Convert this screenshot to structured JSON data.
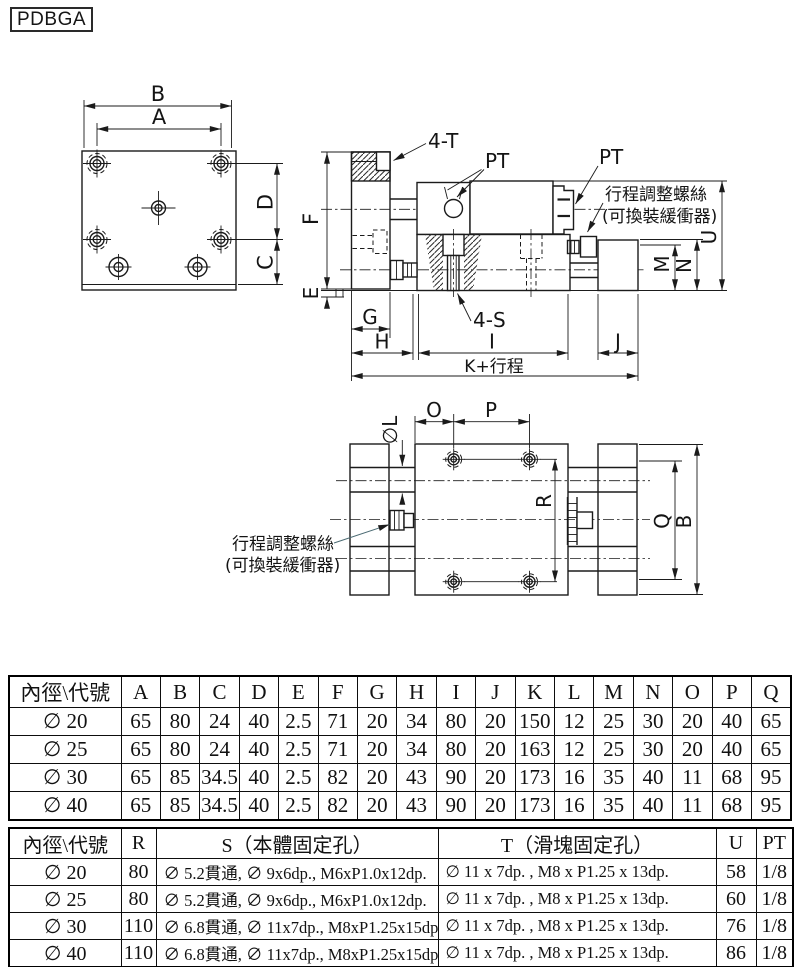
{
  "model_label": "PDBGA",
  "front_view": {
    "dim_B": "B",
    "dim_A": "A",
    "dim_D": "D",
    "dim_C": "C"
  },
  "side_view": {
    "label_4T": "4-T",
    "label_PT_left": "PT",
    "label_PT_right": "PT",
    "note_line1": "行程調整螺絲",
    "note_line2": "(可換裝緩衝器)",
    "label_4S": "4-S",
    "dim_F": "F",
    "dim_E": "E",
    "dim_G": "G",
    "dim_H": "H",
    "dim_I": "I",
    "dim_J": "J",
    "dim_K_stroke": "K+行程",
    "dim_M": "M",
    "dim_N": "N",
    "dim_U": "U"
  },
  "top_view": {
    "dim_O": "O",
    "dim_P": "P",
    "dim_L": "∅L",
    "dim_R": "R",
    "dim_Q": "Q",
    "dim_B": "B",
    "note_line1": "行程調整螺絲",
    "note_line2": "(可換裝緩衝器)"
  },
  "dimension_table": {
    "header": [
      "內徑\\代號",
      "A",
      "B",
      "C",
      "D",
      "E",
      "F",
      "G",
      "H",
      "I",
      "J",
      "K",
      "L",
      "M",
      "N",
      "O",
      "P",
      "Q"
    ],
    "rows": [
      [
        "∅ 20",
        "65",
        "80",
        "24",
        "40",
        "2.5",
        "71",
        "20",
        "34",
        "80",
        "20",
        "150",
        "12",
        "25",
        "30",
        "20",
        "40",
        "65"
      ],
      [
        "∅ 25",
        "65",
        "80",
        "24",
        "40",
        "2.5",
        "71",
        "20",
        "34",
        "80",
        "20",
        "163",
        "12",
        "25",
        "30",
        "20",
        "40",
        "65"
      ],
      [
        "∅ 30",
        "65",
        "85",
        "34.5",
        "40",
        "2.5",
        "82",
        "20",
        "43",
        "90",
        "20",
        "173",
        "16",
        "35",
        "40",
        "11",
        "68",
        "95"
      ],
      [
        "∅ 40",
        "65",
        "85",
        "34.5",
        "40",
        "2.5",
        "82",
        "20",
        "43",
        "90",
        "20",
        "173",
        "16",
        "35",
        "40",
        "11",
        "68",
        "95"
      ]
    ]
  },
  "mounting_table": {
    "header": [
      "內徑\\代號",
      "R",
      "S（本體固定孔）",
      "T（滑塊固定孔）",
      "U",
      "PT"
    ],
    "rows": [
      [
        "∅ 20",
        "80",
        "∅ 5.2貫通, ∅ 9x6dp., M6xP1.0x12dp.",
        "∅ 11 x 7dp. , M8 x P1.25 x 13dp.",
        "58",
        "1/8"
      ],
      [
        "∅ 25",
        "80",
        "∅ 5.2貫通, ∅ 9x6dp., M6xP1.0x12dp.",
        "∅ 11 x 7dp. , M8 x P1.25 x 13dp.",
        "60",
        "1/8"
      ],
      [
        "∅ 30",
        "110",
        "∅ 6.8貫通, ∅ 11x7dp., M8xP1.25x15dp.",
        "∅ 11 x 7dp. , M8 x P1.25 x 13dp.",
        "76",
        "1/8"
      ],
      [
        "∅ 40",
        "110",
        "∅ 6.8貫通, ∅ 11x7dp., M8xP1.25x15dp.",
        "∅ 11 x 7dp. , M8 x P1.25 x 13dp.",
        "86",
        "1/8"
      ]
    ]
  }
}
